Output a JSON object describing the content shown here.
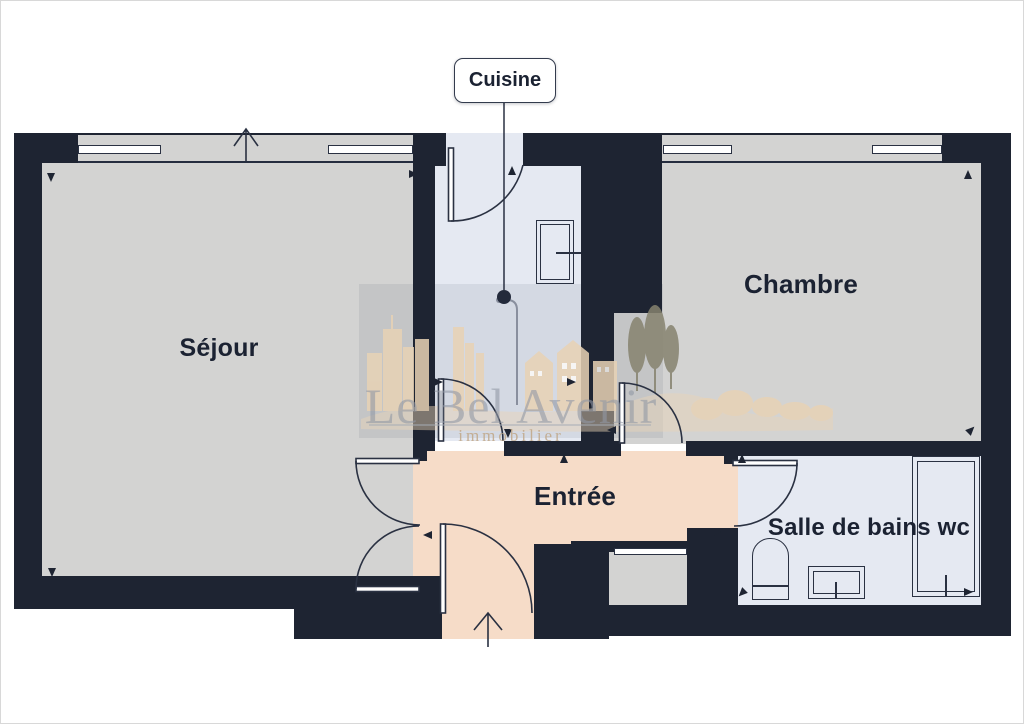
{
  "plan_type": "apartment-floor-plan",
  "rooms": {
    "sejour": {
      "label": "Séjour"
    },
    "cuisine": {
      "label": "Cuisine"
    },
    "chambre": {
      "label": "Chambre"
    },
    "entree": {
      "label": "Entrée"
    },
    "salle_de_bains": {
      "label": "Salle de bains wc"
    }
  },
  "watermark": {
    "brand": "Le Bel Avenir",
    "tagline": "immobilier"
  },
  "colors": {
    "wall": "#1e2432",
    "floor_gray": "#d3d3d2",
    "floor_blue": "#e5e9f2",
    "floor_peach": "#f6dcc8",
    "watermark_beige": "#e9d3b6",
    "label_text": "#1b2232"
  }
}
